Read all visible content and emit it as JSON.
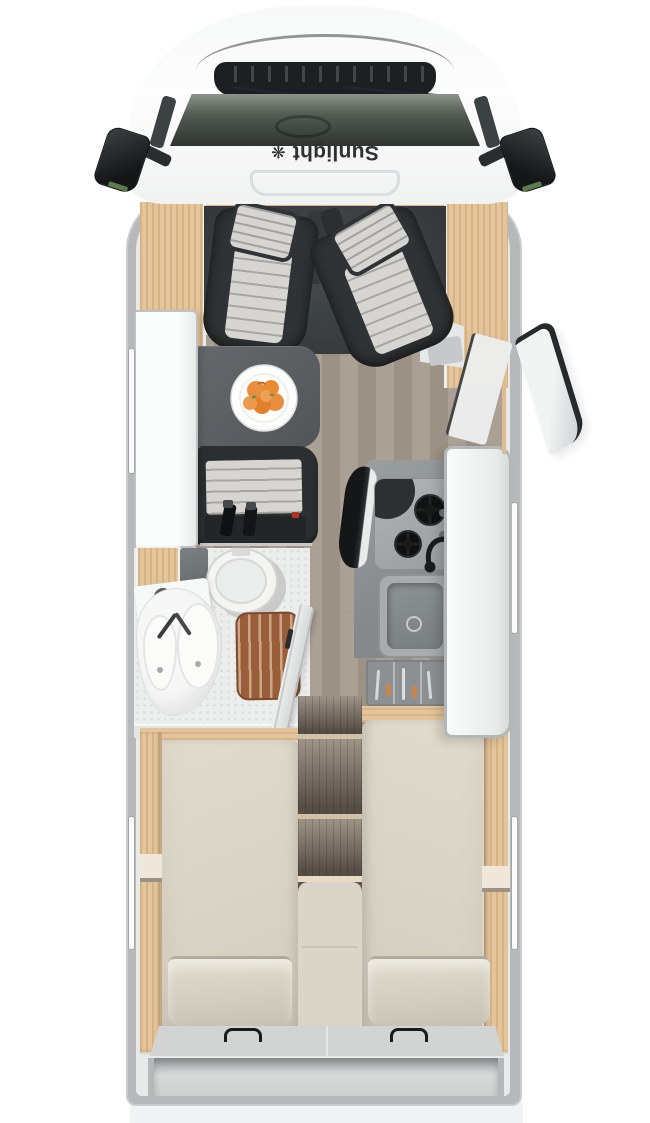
{
  "brand": {
    "decal_text": "Sunlight"
  },
  "colors": {
    "bg": "#ffffff",
    "wall": "#b6b8ba",
    "body-white": "#f9fafa",
    "glass": "#4a524b",
    "vent": "#1d2022",
    "decal-ink": "#2e3032",
    "wood": "#e4c59b",
    "wood-grain": "#c99f6d",
    "cab-floor": "#3e4245",
    "seat-dark": "#303335",
    "cushion": "#d6d5d2",
    "table": "#5a5e61",
    "fruit-orange": "#e78f3e",
    "plank-floor": "#a59a8d",
    "bench-dark": "#2c2f31",
    "belt-red": "#b23425",
    "bath-floor": "#eceded",
    "grate-brown": "#9a5e3a",
    "counter": "#8f9496",
    "steel": "#a8acae",
    "drawer": "#97999c",
    "door-white": "#f2f3f3",
    "seal-dark": "#27292b",
    "mattress": "#dcd6c8",
    "pillow": "#d8d3c5",
    "step-wood": "#8a7e71",
    "cream": "#d9d4c7",
    "rear-gray": "#d2d3d3",
    "ground": "#f2f3f4"
  }
}
